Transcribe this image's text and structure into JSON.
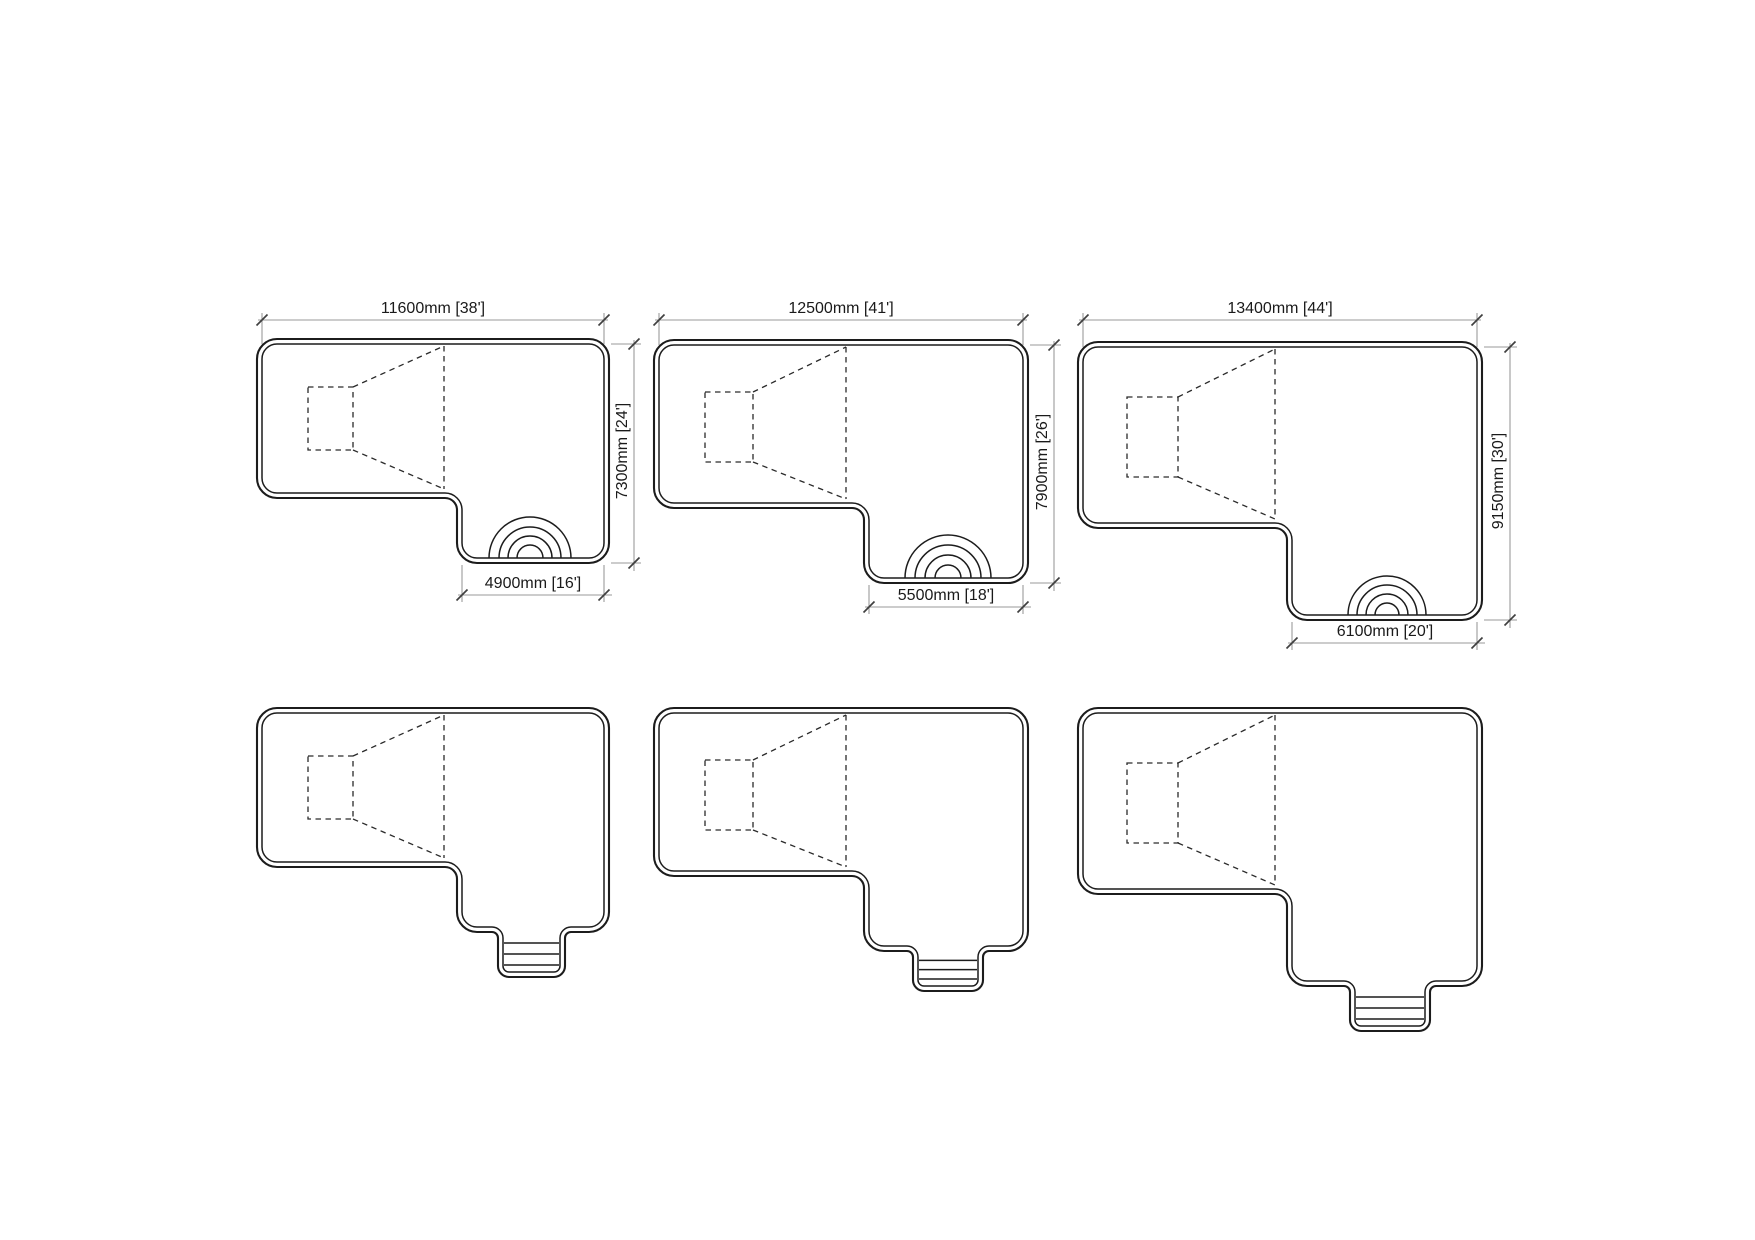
{
  "drawing": {
    "description_note": "",
    "pools": [
      {
        "top_label": "11600mm [38']",
        "side_label": "7300mm [24']",
        "bottom_label": "4900mm [16']"
      },
      {
        "top_label": "12500mm [41']",
        "side_label": "7900mm [26']",
        "bottom_label": "5500mm [18']"
      },
      {
        "top_label": "13400mm [44']",
        "side_label": "9150mm [30']",
        "bottom_label": "6100mm [20']"
      }
    ],
    "colors": {
      "outline": "#1c1c1c",
      "dashed": "#2a2a2a",
      "dimension_line": "#9a9a9a",
      "tick": "#3f3f3f",
      "text": "#1a1a1a",
      "background": "#ffffff"
    }
  }
}
